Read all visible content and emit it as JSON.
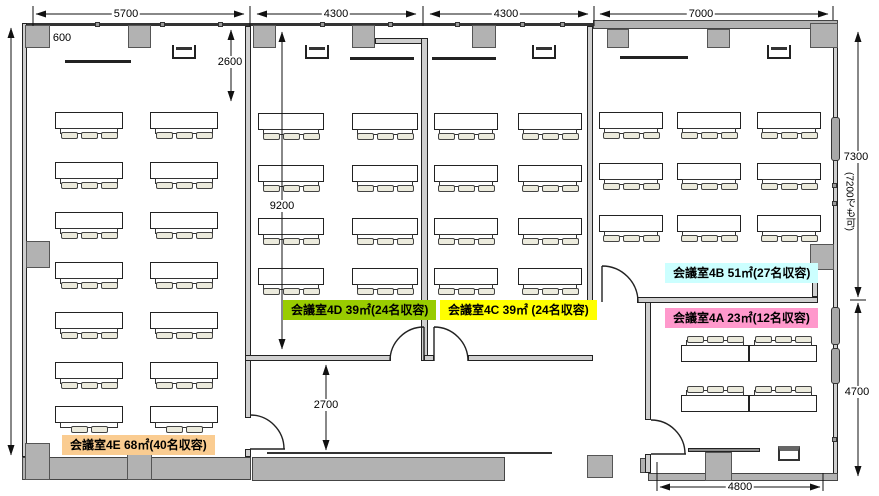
{
  "plan_type": "会議室フロア平面図",
  "rooms": [
    {
      "id": "4E",
      "name": "会議室4E",
      "area": "68㎡",
      "capacity_text": "(40名収容)",
      "label": "会議室4E  68㎡(40名収容)",
      "color": "#FACC91",
      "seats": 40,
      "desks": 14
    },
    {
      "id": "4D",
      "name": "会議室4D",
      "area": "39㎡",
      "capacity_text": "(24名収容)",
      "label": "会議室4D  39㎡(24名収容)",
      "color": "#99CC00",
      "seats": 24,
      "desks": 8
    },
    {
      "id": "4C",
      "name": "会議室4C",
      "area": "39㎡",
      "capacity_text": "(24名収容)",
      "label": "会議室4C  39㎡ (24名収容)",
      "color": "#FFFF00",
      "seats": 24,
      "desks": 8
    },
    {
      "id": "4B",
      "name": "会議室4B",
      "area": "51㎡",
      "capacity_text": "(27名収容)",
      "label": "会議室4B  51㎡(27名収容)",
      "color": "#CCFFFF",
      "seats": 27,
      "desks": 9
    },
    {
      "id": "4A",
      "name": "会議室4A",
      "area": "23㎡",
      "capacity_text": "(12名収容)",
      "label": "会議室4A  23㎡(12名収容)",
      "color": "#FF99CC",
      "seats": 12,
      "desks": 4
    }
  ],
  "dimensions": {
    "top": [
      "5700",
      "4300",
      "4300",
      "7000"
    ],
    "interior": {
      "offset": "600",
      "front": "2600",
      "depth": "9200",
      "corridor": "2700"
    },
    "right_upper": "7300",
    "right_note": "(7200でも可)",
    "right_lower": "4700",
    "bottom": "4800"
  },
  "fixtures": {
    "monitor": "wall-monitor",
    "whiteboard": "whiteboard",
    "counter": "service-counter",
    "equipment": "small-table",
    "door": "swing-door",
    "window": "window",
    "pillar": "pillar"
  }
}
